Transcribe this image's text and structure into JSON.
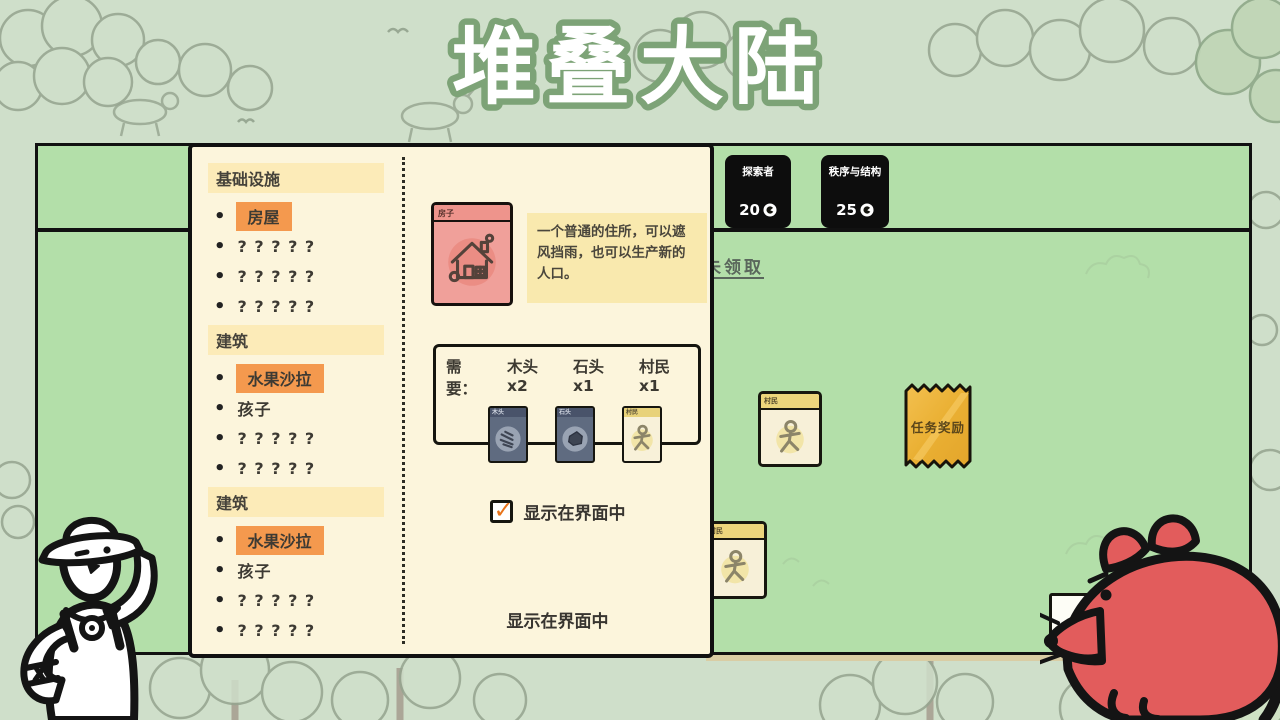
{
  "app": {
    "title": "堆叠大陆"
  },
  "colors": {
    "board_green": "#b3dfa9",
    "panel_cream": "#fcf5dc",
    "highlight_orange": "#f4994e",
    "header_yellow": "#fcebb8",
    "house_card_pink": "#f0a09a",
    "reward_gold": "#eeb33c",
    "pack_black": "#0d0d0d",
    "check_orange": "#e8731a"
  },
  "board": {
    "packs": [
      {
        "name": "探索者",
        "price": "20"
      },
      {
        "name": "秩序与结构",
        "price": "25"
      }
    ],
    "quest_link": "未领取",
    "cards": [
      {
        "name": "村民"
      },
      {
        "name": "村民"
      }
    ],
    "reward_card": {
      "name": "任务奖励"
    }
  },
  "cardopedia": {
    "rows": [
      {
        "type": "header",
        "label": "基础设施"
      },
      {
        "type": "item",
        "label": "房屋",
        "highlight": true
      },
      {
        "type": "item",
        "label": "? ? ? ? ?"
      },
      {
        "type": "item",
        "label": "? ? ? ? ?"
      },
      {
        "type": "item",
        "label": "? ? ? ? ?"
      },
      {
        "type": "header",
        "label": "建筑"
      },
      {
        "type": "item",
        "label": "水果沙拉",
        "highlight": true
      },
      {
        "type": "item",
        "label": "孩子"
      },
      {
        "type": "item",
        "label": "? ? ? ? ?"
      },
      {
        "type": "item",
        "label": "? ? ? ? ?"
      },
      {
        "type": "header",
        "label": "建筑"
      },
      {
        "type": "item",
        "label": "水果沙拉",
        "highlight": true
      },
      {
        "type": "item",
        "label": "孩子"
      },
      {
        "type": "item",
        "label": "? ? ? ? ?"
      },
      {
        "type": "item",
        "label": "? ? ? ? ?"
      },
      {
        "type": "item",
        "label": "? ? ? ? ?"
      },
      {
        "type": "item",
        "label": "? ? ? ? ?"
      }
    ],
    "detail": {
      "card_name": "房子",
      "description": "一个普通的住所，可以遮风挡雨，也可以生产新的人口。",
      "req_label": "需要：",
      "requirements": [
        {
          "text": "木头x2",
          "mini_label": "木头"
        },
        {
          "text": "石头x1",
          "mini_label": "石头"
        },
        {
          "text": "村民x1",
          "mini_label": "村民"
        }
      ],
      "checkbox_label": "显示在界面中",
      "checkbox_checked": true,
      "footer_label": "显示在界面中"
    }
  }
}
